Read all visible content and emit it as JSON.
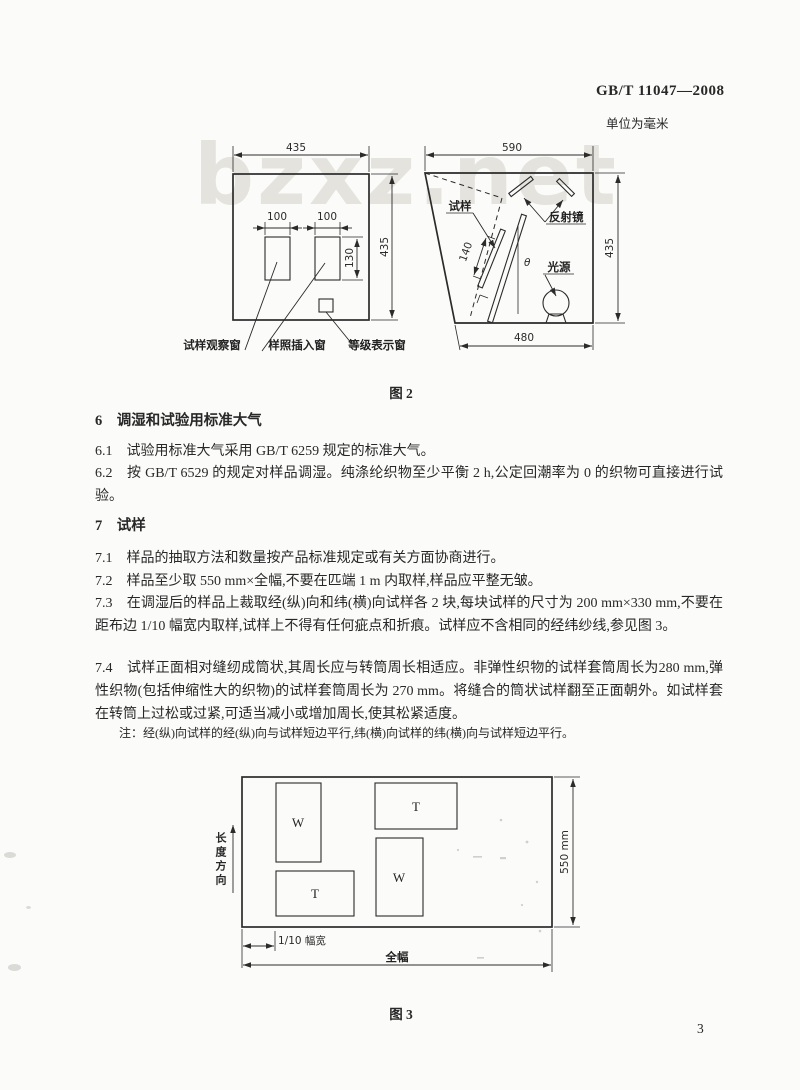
{
  "header": {
    "standard_code": "GB/T 11047—2008",
    "unit_note": "单位为毫米"
  },
  "watermark_text": "bzxz.net",
  "figure2": {
    "caption": "图 2",
    "cabinet_front": {
      "width_dim": "435",
      "height_dim": "435",
      "window_width_dim_1": "100",
      "window_width_dim_2": "100",
      "window_height_dim": "130",
      "label_observe_window": "试样观察窗",
      "label_insert_window": "样照插入窗",
      "label_grade_window": "等级表示窗"
    },
    "cabinet_side": {
      "top_dim": "590",
      "height_dim": "435",
      "bottom_dim": "480",
      "specimen_dim": "140",
      "angle_symbol": "θ",
      "label_specimen": "试样",
      "label_mirror": "反射镜",
      "label_light": "光源"
    }
  },
  "sections": {
    "s6": {
      "heading": "6　调湿和试验用标准大气",
      "c61": "6.1　试验用标准大气采用 GB/T 6259 规定的标准大气。",
      "c62": "6.2　按 GB/T 6529 的规定对样品调湿。纯涤纶织物至少平衡 2 h,公定回潮率为 0 的织物可直接进行试验。"
    },
    "s7": {
      "heading": "7　试样",
      "c71": "7.1　样品的抽取方法和数量按产品标准规定或有关方面协商进行。",
      "c72": "7.2　样品至少取 550 mm×全幅,不要在匹端 1 m 内取样,样品应平整无皱。",
      "c73": "7.3　在调湿后的样品上裁取经(纵)向和纬(横)向试样各 2 块,每块试样的尺寸为 200 mm×330 mm,不要在距布边 1/10 幅宽内取样,试样上不得有任何疵点和折痕。试样应不含相同的经纬纱线,参见图 3。",
      "c74": "7.4　试样正面相对缝纫成筒状,其周长应与转筒周长相适应。非弹性织物的试样套筒周长为280 mm,弹性织物(包括伸缩性大的织物)的试样套筒周长为 270 mm。将缝合的筒状试样翻至正面朝外。如试样套在转筒上过松或过紧,可适当减小或增加周长,使其松紧适度。",
      "note": "注：经(纵)向试样的经(纵)向与试样短边平行,纬(横)向试样的纬(横)向与试样短边平行。"
    }
  },
  "figure3": {
    "caption": "图 3",
    "height_dim": "550 mm",
    "direction_label": "长度方向",
    "selvedge_dim": "1/10 幅宽",
    "full_width_dim": "全幅",
    "blocks": {
      "w1": "W",
      "t1": "T",
      "w2": "W",
      "t2": "T"
    }
  },
  "page_number": "3",
  "colors": {
    "ink": "#2b2b2b",
    "paper": "#fbfbf9",
    "watermark": "#dedcd6"
  }
}
